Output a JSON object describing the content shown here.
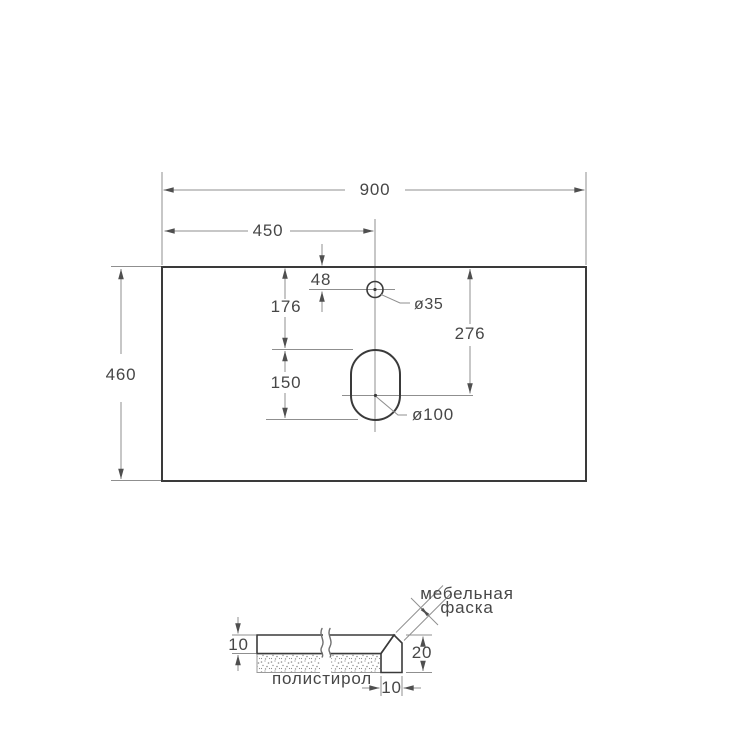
{
  "top_view": {
    "overall_width": "900",
    "centerline_offset": "450",
    "depth": "460",
    "faucet_hole_edge_offset": "48",
    "faucet_hole_diameter": "ø35",
    "drain_hole_top_offset": "176",
    "drain_hole_center_offset": "276",
    "drain_hole_length": "150",
    "drain_hole_diameter": "ø100"
  },
  "section_view": {
    "top_thickness": "10",
    "edge_height": "20",
    "edge_width": "10",
    "chamfer_label_line1": "мебельная",
    "chamfer_label_line2": "фаска",
    "filler_label": "полистирол"
  },
  "colors": {
    "outline": "#3a3a3a",
    "dimension_lines": "#8f8f8f",
    "arrowheads": "#4f4f4f",
    "text": "#474747",
    "background": "#ffffff"
  }
}
